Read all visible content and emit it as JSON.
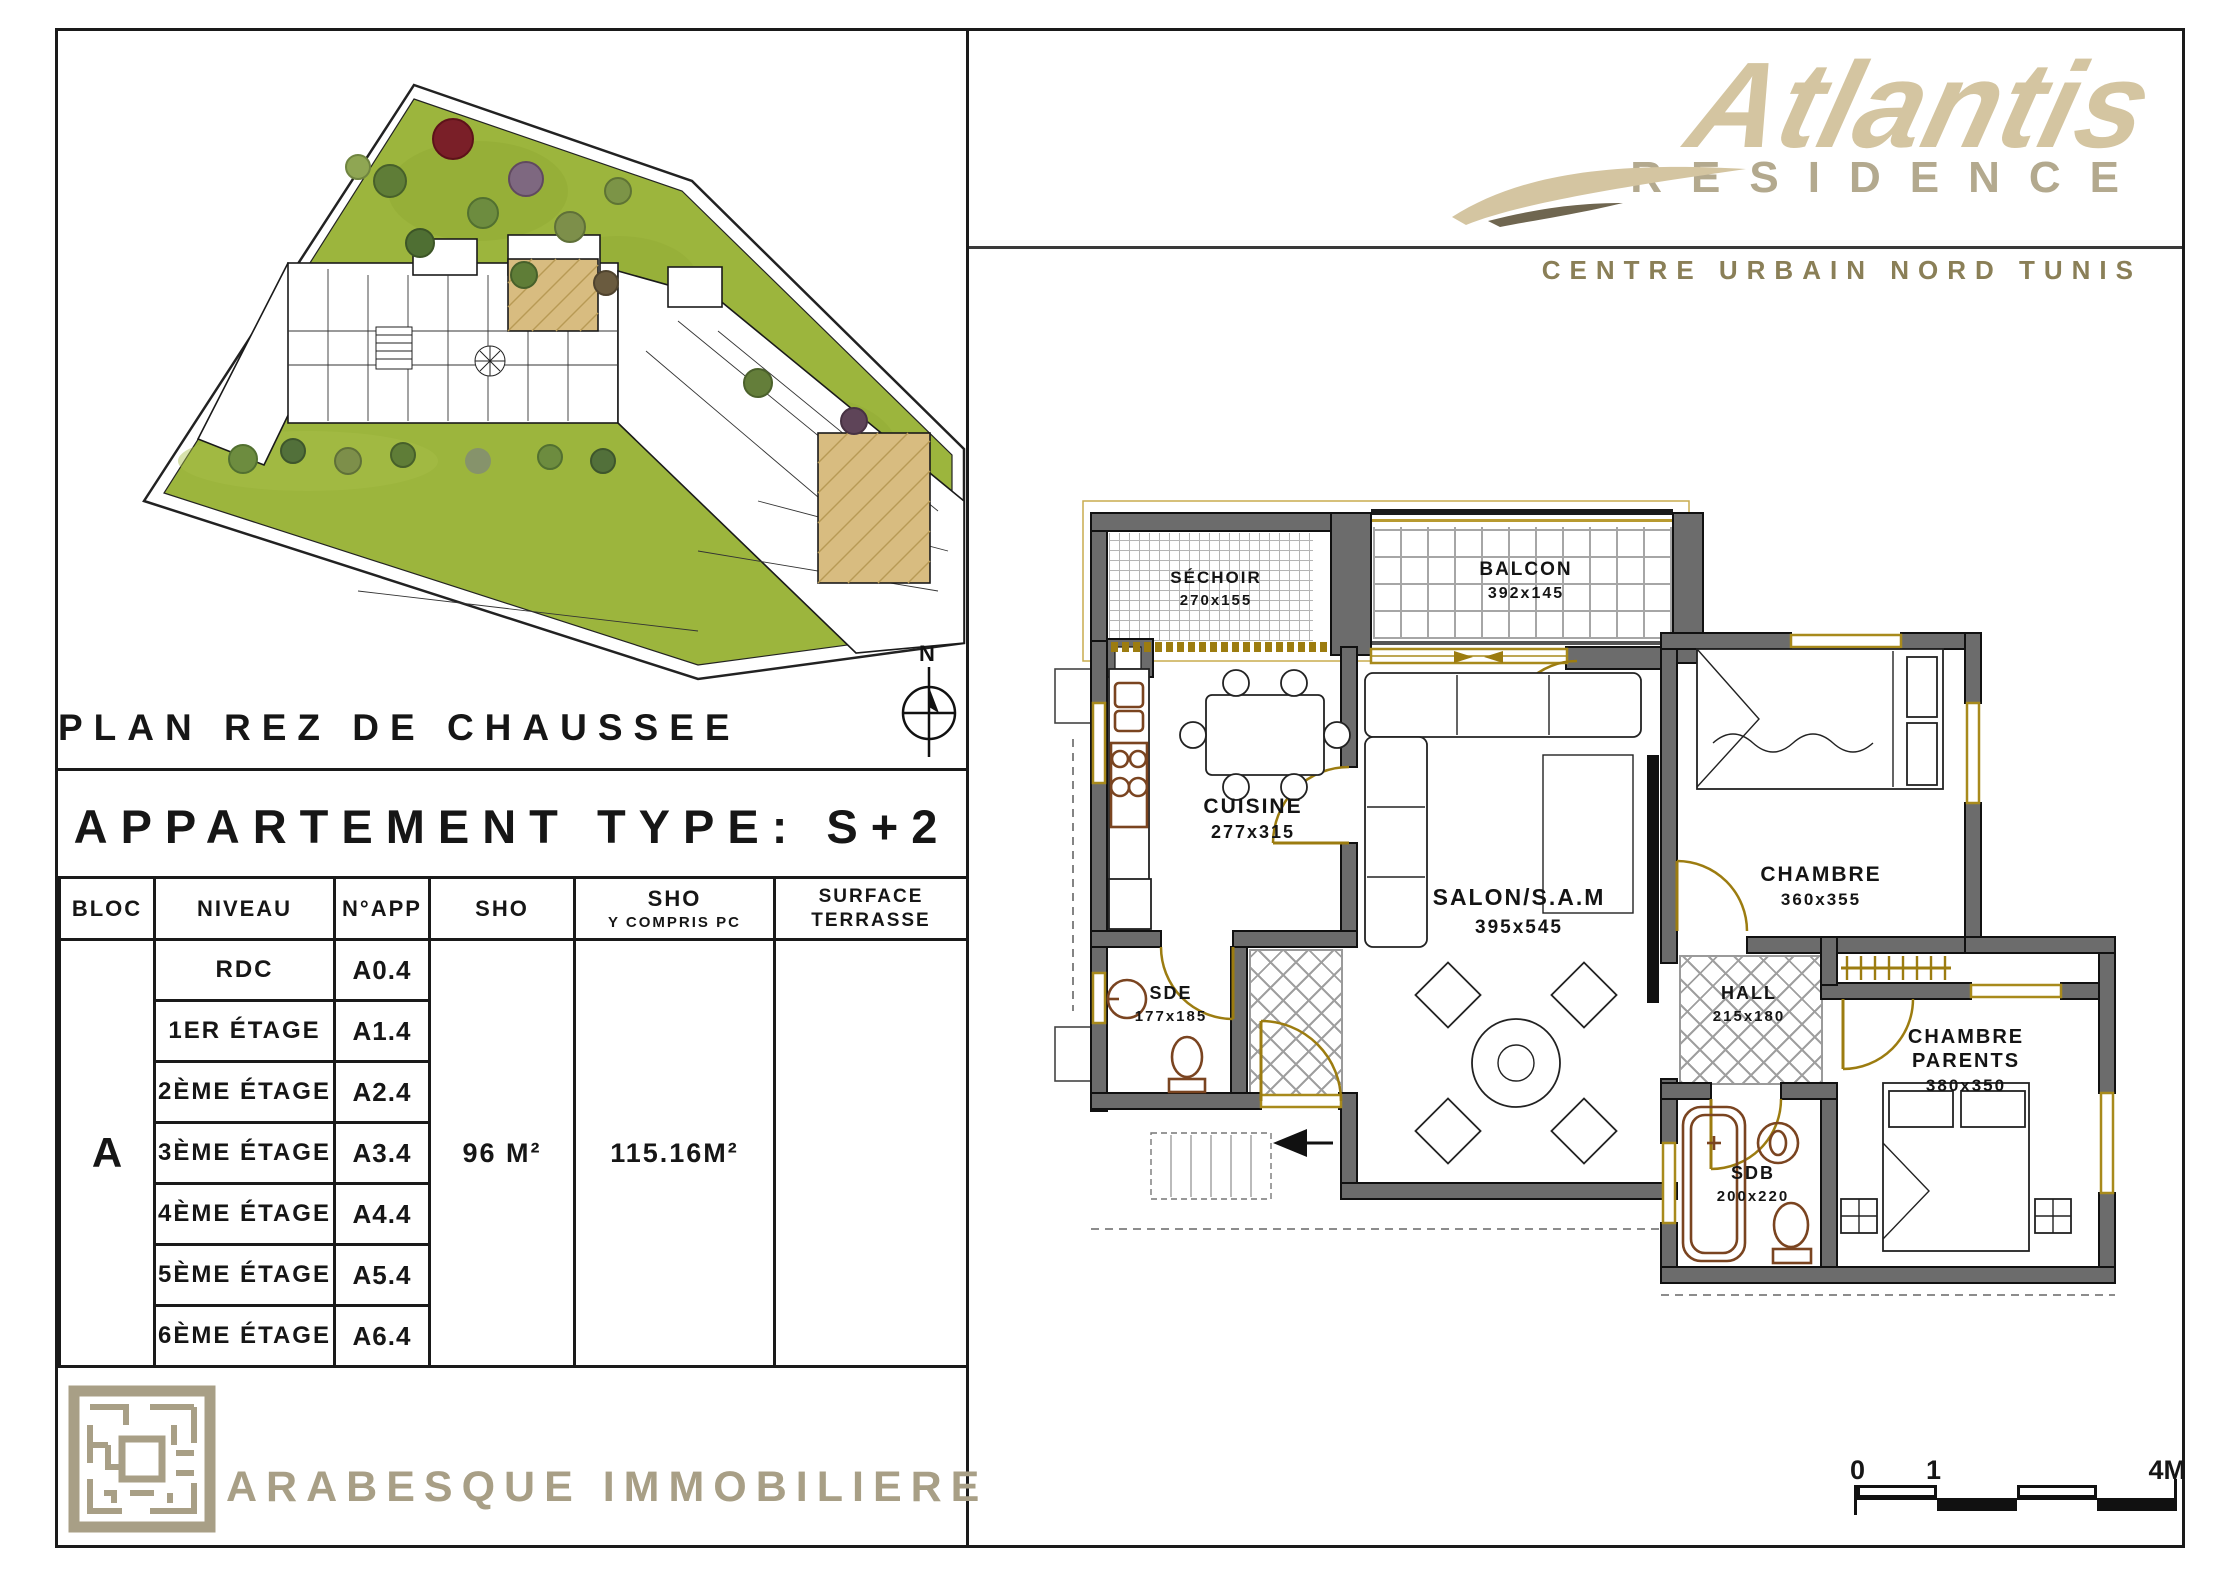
{
  "sheet": {
    "site": {
      "title": "PLAN REZ DE CHAUSSEE",
      "compass_label": "N"
    },
    "apartment_title": "APPARTEMENT TYPE: S+2",
    "table": {
      "headers": {
        "bloc": "BLOC",
        "niveau": "NIVEAU",
        "napp": "N°APP",
        "sho": "SHO",
        "sho_pc_l1": "SHO",
        "sho_pc_l2": "Y COMPRIS PC",
        "terrasse_l1": "SURFACE",
        "terrasse_l2": "TERRASSE"
      },
      "bloc": "A",
      "rows": [
        {
          "niveau": "RDC",
          "napp": "A0.4"
        },
        {
          "niveau": "1ER ÉTAGE",
          "napp": "A1.4"
        },
        {
          "niveau": "2ÈME ÉTAGE",
          "napp": "A2.4"
        },
        {
          "niveau": "3ÈME ÉTAGE",
          "napp": "A3.4"
        },
        {
          "niveau": "4ÈME ÉTAGE",
          "napp": "A4.4"
        },
        {
          "niveau": "5ÈME ÉTAGE",
          "napp": "A5.4"
        },
        {
          "niveau": "6ÈME ÉTAGE",
          "napp": "A6.4"
        }
      ],
      "sho_value": "96 M²",
      "sho_pc_value": "115.16M²",
      "surface_terrasse_value": ""
    },
    "company": "ARABESQUE IMMOBILIERE"
  },
  "brand": {
    "name": "Atlantis",
    "subtitle": "RESIDENCE",
    "location": "CENTRE URBAIN NORD TUNIS"
  },
  "floor_plan": {
    "rooms": {
      "sechoir": {
        "name": "SÉCHOIR",
        "dims": "270x155"
      },
      "balcon": {
        "name": "BALCON",
        "dims": "392x145"
      },
      "cuisine": {
        "name": "CUISINE",
        "dims": "277x315"
      },
      "salon": {
        "name": "SALON/S.A.M",
        "dims": "395x545"
      },
      "chambre": {
        "name": "CHAMBRE",
        "dims": "360x355"
      },
      "hall": {
        "name": "HALL",
        "dims": "215x180"
      },
      "sde": {
        "name": "SDE",
        "dims": "177x185"
      },
      "sdb": {
        "name": "SDB",
        "dims": "200x220"
      },
      "chambre_parents": {
        "name_l1": "CHAMBRE",
        "name_l2": "PARENTS",
        "dims": "380x350"
      }
    }
  },
  "scale_bar": {
    "zero": "0",
    "one": "1",
    "four": "4M"
  },
  "colors": {
    "brand_beige": "#d4c5a1",
    "brand_taupe": "#b3a98e",
    "brand_olive": "#8a7f57",
    "company_taupe": "#a89f86",
    "lawn_green": "#9cb53d",
    "highlight_tan": "#d8bc80",
    "wall_gray": "#6c6c6c",
    "accent_gold": "#9c7c10"
  }
}
